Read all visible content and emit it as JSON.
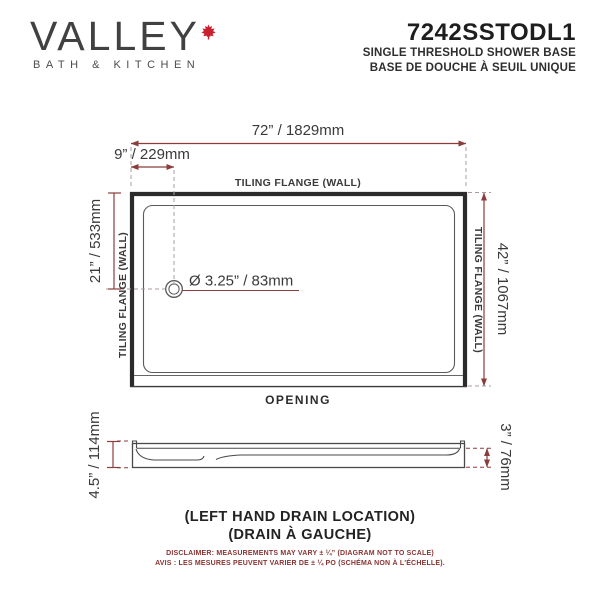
{
  "header": {
    "brand": {
      "name": "VALLEY",
      "tagline": "BATH & KITCHEN",
      "leaf_icon": "maple-leaf",
      "leaf_color": "#c8202e"
    },
    "product": {
      "code": "7242SSTODL1",
      "subtitle_en": "SINGLE THRESHOLD SHOWER BASE",
      "subtitle_fr": "BASE DE DOUCHE À SEUIL UNIQUE"
    }
  },
  "diagram": {
    "type": "technical-drawing",
    "top_view": {
      "width_dim": "72” / 1829mm",
      "drain_offset_dim": "9” / 229mm",
      "drain_depth_dim": "21” / 533mm",
      "height_dim": "42” / 1067mm",
      "drain_diameter_dim": "Ø 3.25” / 83mm",
      "flange_top": "TILING FLANGE (WALL)",
      "flange_left": "TILING FLANGE (WALL)",
      "flange_right": "TILING FLANGE (WALL)",
      "opening_label": "OPENING"
    },
    "side_view": {
      "height_left_dim": "4.5” / 114mm",
      "height_right_dim": "3” / 76mm"
    },
    "colors": {
      "dimension_line": "#8d3c3c",
      "outline": "#2b2b2b",
      "centerline": "#ab9c9c"
    }
  },
  "footer": {
    "drain_location_en": "(LEFT HAND DRAIN LOCATION)",
    "drain_location_fr": "(DRAIN À GAUCHE)",
    "disclaimer_en": "DISCLAIMER: MEASUREMENTS MAY VARY ±  ¼” (DIAGRAM NOT TO SCALE)",
    "disclaimer_fr": "AVIS : LES MESURES PEUVENT VARIER DE ± ¼ PO (SCHÉMA NON À L'ÉCHELLE)."
  }
}
